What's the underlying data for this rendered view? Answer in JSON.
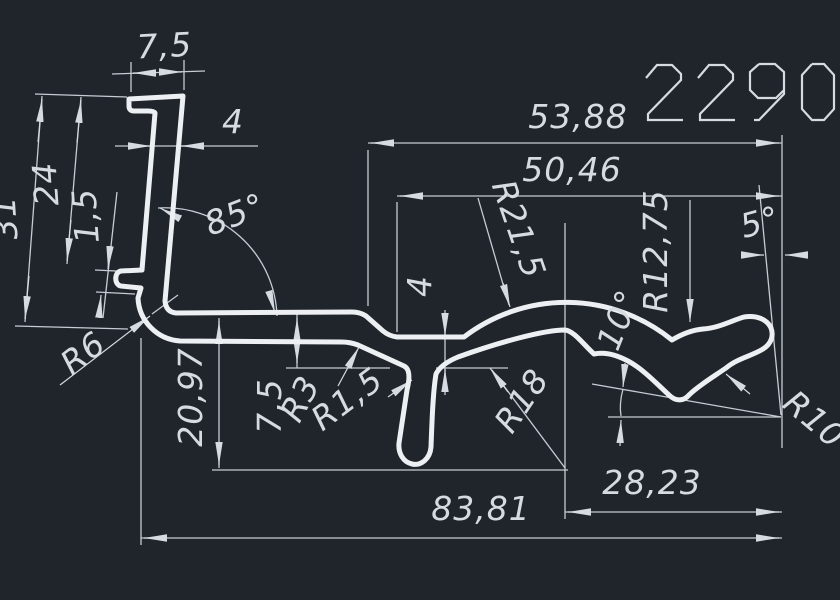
{
  "drawing": {
    "number": "2290"
  },
  "colors": {
    "background": "#20242b",
    "profile_lines": "#edf0f3",
    "dimension_lines": "#c6ccd4",
    "text": "#d6dbe1"
  },
  "dimensions": {
    "linear": [
      "7,5",
      "4",
      "24",
      "1,5",
      "31",
      "53,88",
      "50,46",
      "4",
      "7,5",
      "20,97",
      "28,23",
      "83,81"
    ],
    "radii": [
      "R6",
      "R21,5",
      "R18",
      "R12,75",
      "R10",
      "R3",
      "R1,5"
    ],
    "angles": [
      "85°",
      "5°",
      "10°"
    ]
  },
  "labels": [
    {
      "name": "dim-7-5-top",
      "text": "7,5",
      "x": 165,
      "y": 57,
      "rot": -3,
      "size": 33
    },
    {
      "name": "dim-4-top",
      "text": "4",
      "x": 233,
      "y": 133,
      "rot": 0,
      "size": 33
    },
    {
      "name": "dim-24",
      "text": "24",
      "x": 57,
      "y": 183,
      "rot": -94,
      "size": 33
    },
    {
      "name": "dim-31",
      "text": "31",
      "x": 16,
      "y": 217,
      "rot": -94,
      "size": 33
    },
    {
      "name": "dim-1-5",
      "text": "1,5",
      "x": 97,
      "y": 215,
      "rot": -94,
      "size": 33
    },
    {
      "name": "ang-85",
      "text": "85°",
      "x": 239,
      "y": 225,
      "rot": -21,
      "size": 33
    },
    {
      "name": "dim-53-88",
      "text": "53,88",
      "x": 578,
      "y": 128,
      "rot": 0,
      "size": 33
    },
    {
      "name": "dim-50-46",
      "text": "50,46",
      "x": 572,
      "y": 181,
      "rot": 0,
      "size": 33
    },
    {
      "name": "rad-21-5",
      "text": "R21,5",
      "x": 508,
      "y": 233,
      "rot": 71,
      "size": 33
    },
    {
      "name": "rad-18",
      "text": "R18",
      "x": 531,
      "y": 407,
      "rot": -56,
      "size": 33
    },
    {
      "name": "rad-12-75",
      "text": "R12,75",
      "x": 667,
      "y": 251,
      "rot": -90,
      "size": 33
    },
    {
      "name": "ang-5",
      "text": "5°",
      "x": 763,
      "y": 233,
      "rot": -15,
      "size": 33
    },
    {
      "name": "ang-10",
      "text": "10°",
      "x": 629,
      "y": 324,
      "rot": -68,
      "size": 33
    },
    {
      "name": "rad-10",
      "text": "R10",
      "x": 807,
      "y": 428,
      "rot": 40,
      "size": 33
    },
    {
      "name": "dim-28-23",
      "text": "28,23",
      "x": 652,
      "y": 494,
      "rot": 0,
      "size": 33
    },
    {
      "name": "dim-83-81",
      "text": "83,81",
      "x": 481,
      "y": 520,
      "rot": 0,
      "size": 33
    },
    {
      "name": "dim-20-97",
      "text": "20,97",
      "x": 202,
      "y": 397,
      "rot": -90,
      "size": 33
    },
    {
      "name": "dim-7-5-bot",
      "text": "7,5",
      "x": 281,
      "y": 406,
      "rot": -90,
      "size": 33
    },
    {
      "name": "dim-4-mid",
      "text": "4",
      "x": 431,
      "y": 286,
      "rot": -90,
      "size": 33
    },
    {
      "name": "rad-3",
      "text": "R3",
      "x": 310,
      "y": 404,
      "rot": -62,
      "size": 33
    },
    {
      "name": "rad-1-5",
      "text": "R1,5",
      "x": 354,
      "y": 408,
      "rot": -37,
      "size": 33
    },
    {
      "name": "rad-6",
      "text": "R6",
      "x": 90,
      "y": 362,
      "rot": -38,
      "size": 33
    }
  ]
}
